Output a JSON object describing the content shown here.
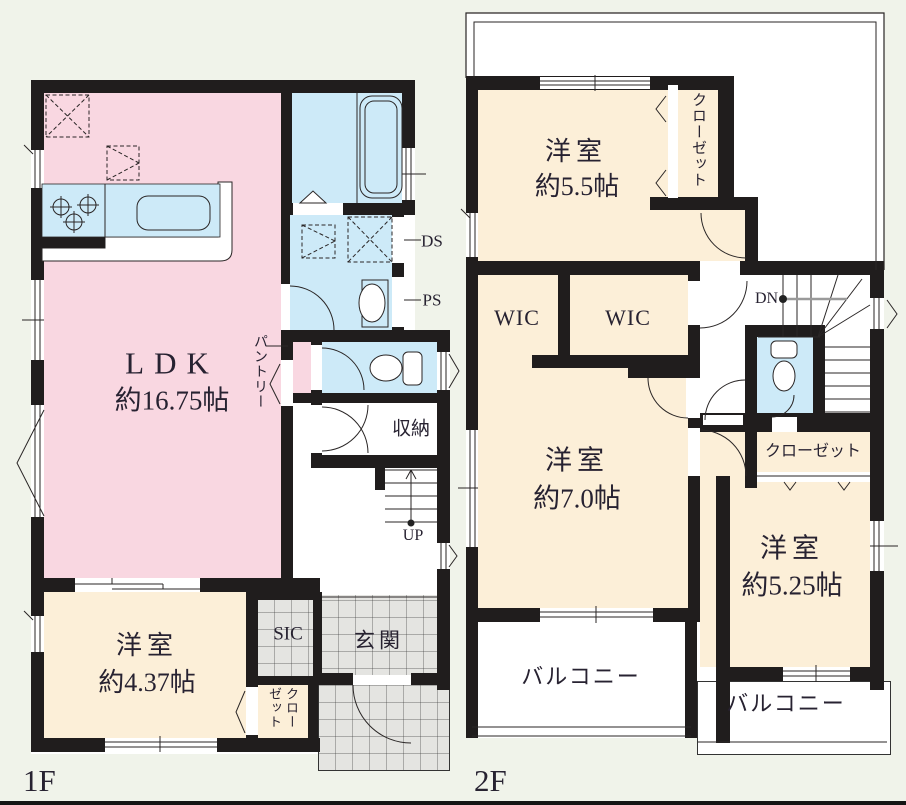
{
  "canvas": {
    "background": "#f0f3ea",
    "wall_color": "#201d1d",
    "ldk_color": "#f9d7e1",
    "bedroom_color": "#fcefd8",
    "wet_area_color": "#cdeaf8",
    "tile_color": "#e4e4e1"
  },
  "floor1": {
    "floor_label": "1F",
    "ldk_name": "LDK",
    "ldk_size": "約16.75帖",
    "bedroom_name": "洋室",
    "bedroom_size": "約4.37帖",
    "pantry_label": "パントリー",
    "storage_label": "収納",
    "stairs_up_label": "UP",
    "sic_label": "SIC",
    "entrance_label": "玄関",
    "closet_label": "クローゼット",
    "ds_label": "DS",
    "ps_label": "PS"
  },
  "floor2": {
    "floor_label": "2F",
    "bedroom_a_name": "洋室",
    "bedroom_a_size": "約5.5帖",
    "bedroom_b_name": "洋室",
    "bedroom_b_size": "約7.0帖",
    "bedroom_c_name": "洋室",
    "bedroom_c_size": "約5.25帖",
    "closet_a_label": "クローゼット",
    "closet_b_label": "クローゼット",
    "wic_a_label": "WIC",
    "wic_b_label": "WIC",
    "balcony_a_label": "バルコニー",
    "balcony_b_label": "バルコニー",
    "stairs_down_label": "DN"
  }
}
